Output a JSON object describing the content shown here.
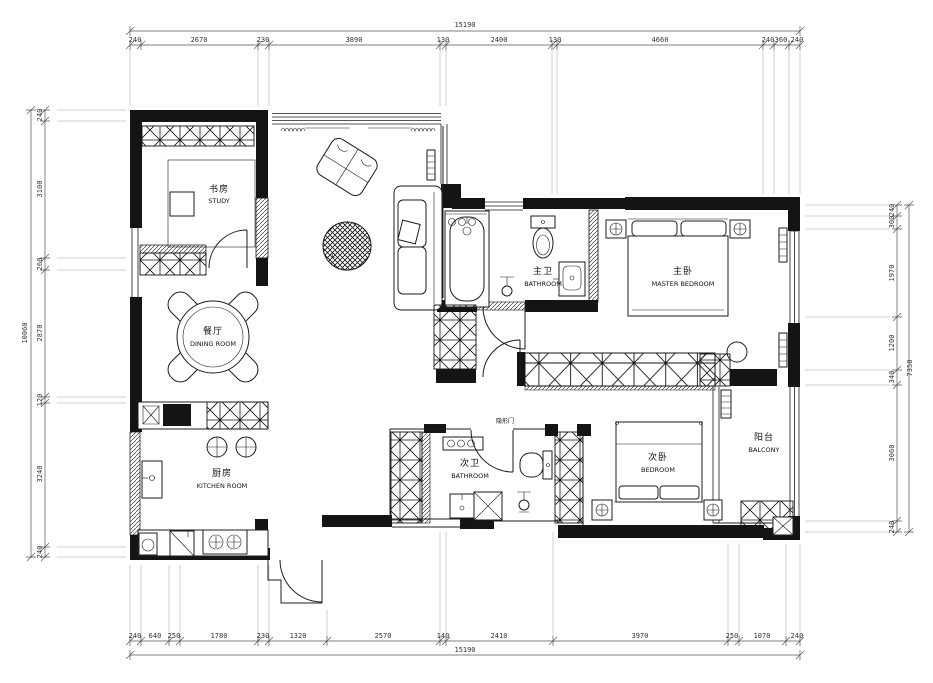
{
  "drawing": {
    "type": "residential floor plan",
    "colors": {
      "wall": "#141414",
      "line": "#1c1c1c",
      "dimension": "#333333",
      "background": "#ffffff"
    }
  },
  "rooms": {
    "study": {
      "cn": "书房",
      "en": "STUDY"
    },
    "dining": {
      "cn": "餐厅",
      "en": "DINING ROOM"
    },
    "kitchen": {
      "cn": "厨房",
      "en": "KITCHEN ROOM"
    },
    "living": {
      "label": "L"
    },
    "master_bathroom": {
      "cn": "主卫",
      "en": "BATHROOM"
    },
    "master_bedroom": {
      "cn": "主卧",
      "en": "MASTER BEDROOM"
    },
    "second_bathroom": {
      "cn": "次卫",
      "en": "BATHROOM"
    },
    "second_bedroom": {
      "cn": "次卧",
      "en": "BEDROOM"
    },
    "balcony": {
      "cn": "阳台",
      "en": "BALCONY"
    },
    "hidden_door": {
      "cn": "隐形门"
    }
  },
  "dimensions": {
    "top": {
      "total": "15190",
      "segments": [
        "240",
        "2670",
        "230",
        "3890",
        "130",
        "2400",
        "130",
        "4660",
        "240",
        "360",
        "240"
      ]
    },
    "bottom": {
      "total": "15190",
      "segments": [
        "240",
        "640",
        "250",
        "1780",
        "230",
        "1320",
        "2570",
        "140",
        "2410",
        "3970",
        "250",
        "1070",
        "240"
      ]
    },
    "left": {
      "total": "10060",
      "segments": [
        "240",
        "3100",
        "260",
        "2870",
        "120",
        "3240",
        "240"
      ]
    },
    "right": {
      "total": "7350",
      "segments": [
        "240",
        "300",
        "1970",
        "1200",
        "340",
        "3060",
        "240"
      ]
    }
  }
}
